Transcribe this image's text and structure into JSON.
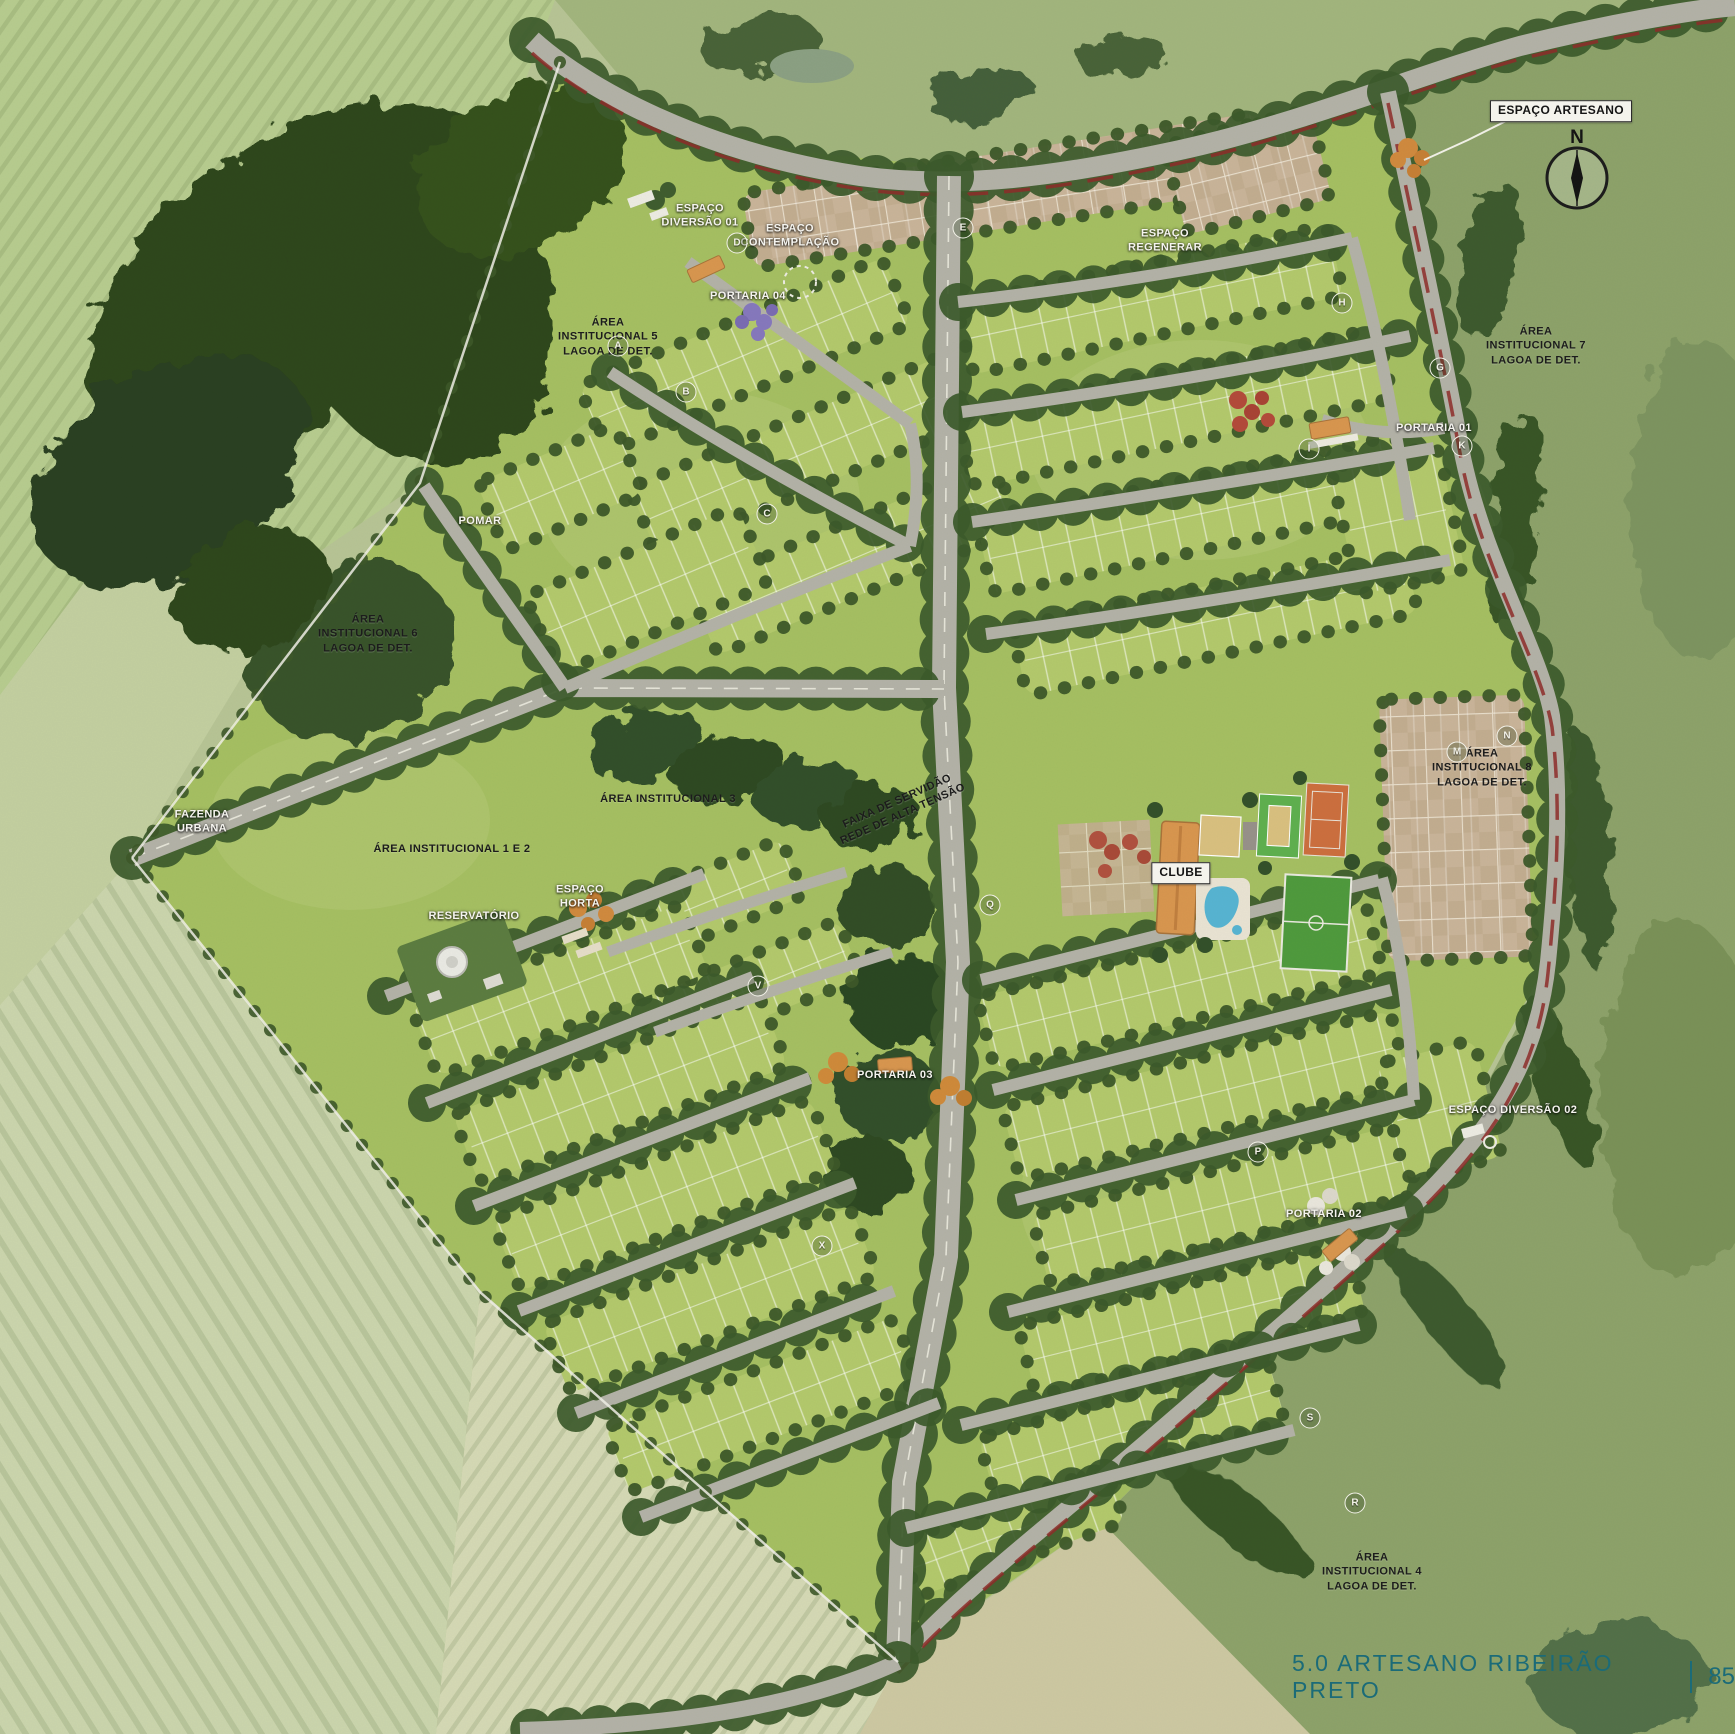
{
  "footer": {
    "caption": "5.0 ARTESANO RIBEIRÃO PRETO",
    "page": "85"
  },
  "compass": {
    "label": "N"
  },
  "colors": {
    "footer_teal": "#1b6b78",
    "label_light": "#f5f4ef",
    "label_dark": "#1c1c1c",
    "parcel_green": "#a5bf62",
    "block_green": "#b3c96c",
    "road_gray": "#b3b2a7",
    "tree_green": "#3c5a2b",
    "forest_green": "#2e461f",
    "paver_tan": "#c9b499",
    "accent_red": "#8e2b29",
    "pool_blue": "#57b4d2",
    "tennis_orange": "#cc6f3e",
    "soccer_green": "#4f9a3d",
    "clubhouse_orange": "#d8964f"
  },
  "labels": [
    {
      "text": "ESPAÇO ARTESANO",
      "x": 1561,
      "y": 111,
      "style": "boxed"
    },
    {
      "text": "ESPAÇO\nDIVERSÃO 01",
      "x": 700,
      "y": 216,
      "style": "light"
    },
    {
      "text": "ESPAÇO\nCONTEMPLAÇÃO",
      "x": 790,
      "y": 236,
      "style": "light"
    },
    {
      "text": "PORTARIA 04",
      "x": 748,
      "y": 296,
      "style": "light"
    },
    {
      "text": "ÁREA\nINSTITUCIONAL 5\nLAGOA DE DET.",
      "x": 608,
      "y": 337,
      "style": "dark"
    },
    {
      "text": "POMAR",
      "x": 480,
      "y": 521,
      "style": "light"
    },
    {
      "text": "ÁREA\nINSTITUCIONAL 6\nLAGOA DE DET.",
      "x": 368,
      "y": 634,
      "style": "dark"
    },
    {
      "text": "FAZENDA\nURBANA",
      "x": 202,
      "y": 822,
      "style": "light"
    },
    {
      "text": "ÁREA INSTITUCIONAL 1 E 2",
      "x": 452,
      "y": 849,
      "style": "dark"
    },
    {
      "text": "ÁREA INSTITUCIONAL 3",
      "x": 668,
      "y": 799,
      "style": "dark"
    },
    {
      "text": "FAIXA DE SERVIDÃO\nREDE DE ALTA TENSÃO",
      "x": 900,
      "y": 808,
      "style": "dark",
      "rotate": -24
    },
    {
      "text": "RESERVATÓRIO",
      "x": 474,
      "y": 916,
      "style": "light"
    },
    {
      "text": "ESPAÇO\nHORTA",
      "x": 580,
      "y": 897,
      "style": "light"
    },
    {
      "text": "ESPAÇO\nREGENERAR",
      "x": 1165,
      "y": 241,
      "style": "light"
    },
    {
      "text": "PORTARIA 01",
      "x": 1434,
      "y": 428,
      "style": "light"
    },
    {
      "text": "ÁREA\nINSTITUCIONAL 7\nLAGOA DE DET.",
      "x": 1536,
      "y": 346,
      "style": "dark"
    },
    {
      "text": "ÁREA\nINSTITUCIONAL 8\nLAGOA DE DET.",
      "x": 1482,
      "y": 768,
      "style": "dark"
    },
    {
      "text": "PORTARIA 03",
      "x": 895,
      "y": 1075,
      "style": "light"
    },
    {
      "text": "ESPAÇO DIVERSÃO 02",
      "x": 1513,
      "y": 1110,
      "style": "light"
    },
    {
      "text": "PORTARIA 02",
      "x": 1324,
      "y": 1214,
      "style": "light"
    },
    {
      "text": "ÁREA\nINSTITUCIONAL 4\nLAGOA DE DET.",
      "x": 1372,
      "y": 1572,
      "style": "dark"
    },
    {
      "text": "CLUBE",
      "x": 1181,
      "y": 873,
      "style": "boxed"
    }
  ],
  "block_markers": [
    {
      "letter": "A",
      "x": 618,
      "y": 346
    },
    {
      "letter": "B",
      "x": 686,
      "y": 392
    },
    {
      "letter": "C",
      "x": 767,
      "y": 514
    },
    {
      "letter": "D",
      "x": 737,
      "y": 243
    },
    {
      "letter": "E",
      "x": 963,
      "y": 228
    },
    {
      "letter": "G",
      "x": 1440,
      "y": 368
    },
    {
      "letter": "H",
      "x": 1342,
      "y": 303
    },
    {
      "letter": "I",
      "x": 1309,
      "y": 449
    },
    {
      "letter": "K",
      "x": 1462,
      "y": 446
    },
    {
      "letter": "M",
      "x": 1457,
      "y": 752
    },
    {
      "letter": "N",
      "x": 1507,
      "y": 736
    },
    {
      "letter": "Q",
      "x": 990,
      "y": 905
    },
    {
      "letter": "V",
      "x": 758,
      "y": 986
    },
    {
      "letter": "P",
      "x": 1258,
      "y": 1152
    },
    {
      "letter": "X",
      "x": 822,
      "y": 1246
    },
    {
      "letter": "S",
      "x": 1310,
      "y": 1418
    },
    {
      "letter": "R",
      "x": 1355,
      "y": 1503
    }
  ],
  "map": {
    "parcel": {
      "pts": "560,62 640,100 800,152 1005,172 1390,92 1458,430 1560,700 1548,960 1420,1198 1100,1520 897,1660 480,1290 130,857 420,483",
      "fill": "#a5bf62"
    },
    "fields": [
      {
        "pts": "0,0 555,0 520,95 420,483 300,565 90,575 0,695",
        "fill": "#b7cc8f",
        "stripes": "rows35"
      },
      {
        "pts": "0,695 90,575 300,565 255,655 132,858 0,1005",
        "fill": "#c3cfa0"
      },
      {
        "pts": "0,1005 132,858 480,1292 436,1734 0,1734",
        "fill": "#cbd5ad",
        "stripes": "rowsM30"
      },
      {
        "pts": "436,1734 480,1292 700,1480 898,1662 860,1734",
        "fill": "#d5d9b5",
        "stripes": "rows35"
      },
      {
        "pts": "860,1734 898,1662 1100,1520 1310,1734",
        "fill": "#cdc8a2"
      },
      {
        "pts": "1310,1734 1100,1520 1430,1190 1552,962 1560,700 1460,430 1388,92 1520,48 1735,0 1735,1734",
        "fill": "#8da26a"
      },
      {
        "pts": "520,0 1735,0 1520,48 1180,150 1005,170 860,175 640,100 555,0",
        "fill": "#a2b57d"
      }
    ],
    "mottle": [
      {
        "cx": 700,
        "cy": 500,
        "rx": 160,
        "ry": 110
      },
      {
        "cx": 1200,
        "cy": 450,
        "rx": 170,
        "ry": 110
      },
      {
        "cx": 660,
        "cy": 1180,
        "rx": 150,
        "ry": 110
      },
      {
        "cx": 1180,
        "cy": 1200,
        "rx": 160,
        "ry": 120
      },
      {
        "cx": 350,
        "cy": 820,
        "rx": 140,
        "ry": 90
      }
    ],
    "forest": [
      {
        "cx": 300,
        "cy": 280,
        "rx": 240,
        "ry": 140,
        "rot": -35,
        "fill": "#2e461f"
      },
      {
        "cx": 170,
        "cy": 470,
        "rx": 150,
        "ry": 100,
        "rot": -35,
        "fill": "#2a4120"
      },
      {
        "cx": 420,
        "cy": 300,
        "rx": 130,
        "ry": 170,
        "rot": -20,
        "fill": "#2e461f"
      },
      {
        "cx": 520,
        "cy": 170,
        "rx": 110,
        "ry": 80,
        "rot": -30,
        "fill": "#35511f"
      },
      {
        "cx": 350,
        "cy": 650,
        "rx": 105,
        "ry": 85,
        "rot": -25,
        "fill": "#39522a"
      },
      {
        "cx": 250,
        "cy": 590,
        "rx": 80,
        "ry": 60,
        "rot": -25,
        "fill": "#2e461f"
      },
      {
        "cx": 645,
        "cy": 745,
        "rx": 60,
        "ry": 34,
        "rot": -15,
        "fill": "#33502a"
      },
      {
        "cx": 730,
        "cy": 770,
        "rx": 58,
        "ry": 32,
        "rot": -12,
        "fill": "#2f4a24"
      },
      {
        "cx": 810,
        "cy": 795,
        "rx": 55,
        "ry": 32,
        "rot": -10,
        "fill": "#33502a"
      },
      {
        "cx": 872,
        "cy": 818,
        "rx": 48,
        "ry": 30,
        "rot": -10,
        "fill": "#2f4a24"
      },
      {
        "cx": 885,
        "cy": 905,
        "rx": 50,
        "ry": 40,
        "rot": 0,
        "fill": "#314d26"
      },
      {
        "cx": 900,
        "cy": 1000,
        "rx": 55,
        "ry": 48,
        "rot": 0,
        "fill": "#2c4621"
      },
      {
        "cx": 888,
        "cy": 1095,
        "rx": 52,
        "ry": 46,
        "rot": 0,
        "fill": "#33502a"
      },
      {
        "cx": 868,
        "cy": 1175,
        "rx": 45,
        "ry": 38,
        "rot": 0,
        "fill": "#2f4a24"
      },
      {
        "cx": 760,
        "cy": 45,
        "rx": 60,
        "ry": 28,
        "rot": -8,
        "fill": "#4a6337"
      },
      {
        "cx": 980,
        "cy": 95,
        "rx": 55,
        "ry": 25,
        "rot": -8,
        "fill": "#44603a"
      },
      {
        "cx": 1120,
        "cy": 55,
        "rx": 45,
        "ry": 20,
        "rot": -8,
        "fill": "#4a6337"
      },
      {
        "cx": 1490,
        "cy": 260,
        "rx": 26,
        "ry": 80,
        "rot": 12,
        "fill": "#3c5a2e"
      },
      {
        "cx": 1515,
        "cy": 520,
        "rx": 24,
        "ry": 110,
        "rot": 6,
        "fill": "#375428"
      },
      {
        "cx": 1588,
        "cy": 850,
        "rx": 22,
        "ry": 120,
        "rot": -4,
        "fill": "#3c5a2e"
      },
      {
        "cx": 1560,
        "cy": 1080,
        "rx": 24,
        "ry": 90,
        "rot": -18,
        "fill": "#375428"
      },
      {
        "cx": 1450,
        "cy": 1320,
        "rx": 24,
        "ry": 90,
        "rot": -38,
        "fill": "#3c5a2e"
      },
      {
        "cx": 1240,
        "cy": 1520,
        "rx": 26,
        "ry": 90,
        "rot": -52,
        "fill": "#375428"
      },
      {
        "cx": 1620,
        "cy": 1680,
        "rx": 90,
        "ry": 60,
        "rot": 0,
        "fill": "#52704a"
      },
      {
        "cx": 1700,
        "cy": 500,
        "rx": 70,
        "ry": 160,
        "rot": 0,
        "fill": "#7d9460"
      },
      {
        "cx": 1680,
        "cy": 1100,
        "rx": 80,
        "ry": 180,
        "rot": 0,
        "fill": "#7a9158"
      }
    ],
    "blocks": [
      {
        "cx": 745,
        "cy": 355,
        "w": 330,
        "h": 72,
        "r": -23
      },
      {
        "cx": 800,
        "cy": 455,
        "w": 340,
        "h": 72,
        "r": -23
      },
      {
        "cx": 855,
        "cy": 558,
        "w": 330,
        "h": 72,
        "r": -23
      },
      {
        "cx": 648,
        "cy": 590,
        "w": 230,
        "h": 84,
        "r": -23
      },
      {
        "cx": 560,
        "cy": 488,
        "w": 150,
        "h": 74,
        "r": -23
      },
      {
        "cx": 1150,
        "cy": 300,
        "w": 380,
        "h": 72,
        "r": -12
      },
      {
        "cx": 1175,
        "cy": 408,
        "w": 430,
        "h": 72,
        "r": -12
      },
      {
        "cx": 1195,
        "cy": 515,
        "w": 430,
        "h": 72,
        "r": -12
      },
      {
        "cx": 1215,
        "cy": 620,
        "w": 400,
        "h": 70,
        "r": -12
      },
      {
        "cx": 1398,
        "cy": 520,
        "w": 110,
        "h": 130,
        "r": -12
      },
      {
        "cx": 700,
        "cy": 905,
        "w": 200,
        "h": 62,
        "r": -22
      },
      {
        "cx": 748,
        "cy": 990,
        "w": 220,
        "h": 62,
        "r": -22
      },
      {
        "cx": 560,
        "cy": 990,
        "w": 290,
        "h": 74,
        "r": -21
      },
      {
        "cx": 620,
        "cy": 1090,
        "w": 330,
        "h": 76,
        "r": -21
      },
      {
        "cx": 665,
        "cy": 1195,
        "w": 340,
        "h": 76,
        "r": -21
      },
      {
        "cx": 710,
        "cy": 1300,
        "w": 330,
        "h": 74,
        "r": -21
      },
      {
        "cx": 762,
        "cy": 1405,
        "w": 310,
        "h": 70,
        "r": -21
      },
      {
        "cx": 1180,
        "cy": 985,
        "w": 400,
        "h": 74,
        "r": -14
      },
      {
        "cx": 1205,
        "cy": 1095,
        "w": 400,
        "h": 74,
        "r": -14
      },
      {
        "cx": 1225,
        "cy": 1205,
        "w": 380,
        "h": 72,
        "r": -14
      },
      {
        "cx": 1192,
        "cy": 1320,
        "w": 340,
        "h": 72,
        "r": -14
      },
      {
        "cx": 1132,
        "cy": 1430,
        "w": 300,
        "h": 68,
        "r": -16
      },
      {
        "cx": 1012,
        "cy": 1532,
        "w": 220,
        "h": 58,
        "r": -20
      },
      {
        "cx": 1440,
        "cy": 1110,
        "w": 100,
        "h": 120,
        "r": -14
      },
      {
        "cx": 1005,
        "cy": 190,
        "w": 520,
        "h": 75,
        "r": -9,
        "t": "paver"
      },
      {
        "cx": 1248,
        "cy": 172,
        "w": 150,
        "h": 92,
        "r": -14,
        "t": "paver"
      },
      {
        "cx": 1456,
        "cy": 828,
        "w": 145,
        "h": 262,
        "r": -2,
        "t": "paver"
      }
    ],
    "roads": [
      {
        "d": "M532,40 C585,88 700,152 860,176 C960,190 1060,176 1180,150 C1300,124 1420,74 1520,46 C1610,24 1690,10 1735,6",
        "w": 20,
        "trees": 1,
        "red": 1
      },
      {
        "d": "M1388,92 C1412,205 1438,325 1460,442 C1480,556 1540,648 1552,716 C1562,800 1556,882 1548,962 C1538,1058 1496,1122 1430,1190 C1356,1262 1238,1362 1146,1442 C1040,1533 958,1594 898,1662",
        "w": 16,
        "trees": 1,
        "red": 1
      },
      {
        "d": "M949,176 L944,688 L958,962 L946,1256 L904,1482 L898,1662",
        "w": 24,
        "trees": 1,
        "dash": 1
      },
      {
        "d": "M132,858 L565,688 L944,689",
        "w": 18,
        "trees": 1,
        "dash": 1
      },
      {
        "d": "M424,486 C468,552 520,622 565,688",
        "w": 13,
        "trees": 1
      },
      {
        "d": "M688,262 C768,320 840,372 910,424",
        "w": 12
      },
      {
        "d": "M610,372 C700,432 806,492 910,546",
        "w": 12,
        "trees": 1
      },
      {
        "d": "M565,688 C680,638 795,590 910,546",
        "w": 12
      },
      {
        "d": "M910,424 C920,465 918,506 910,546",
        "w": 12
      },
      {
        "d": "M958,302 C1100,286 1240,262 1352,238",
        "w": 12,
        "trees": 1
      },
      {
        "d": "M962,412 C1110,392 1268,366 1410,336",
        "w": 12,
        "trees": 1
      },
      {
        "d": "M972,522 C1122,500 1282,474 1434,448",
        "w": 12,
        "trees": 1
      },
      {
        "d": "M986,634 C1132,614 1292,588 1450,560",
        "w": 12,
        "trees": 1
      },
      {
        "d": "M1352,238 C1378,332 1396,428 1410,520",
        "w": 12
      },
      {
        "d": "M1322,420 C1360,432 1402,436 1444,428",
        "w": 12
      },
      {
        "d": "M981,980 L1379,880",
        "w": 12,
        "trees": 1
      },
      {
        "d": "M993,1090 L1391,990",
        "w": 12,
        "trees": 1
      },
      {
        "d": "M1016,1200 L1414,1100",
        "w": 12,
        "trees": 1
      },
      {
        "d": "M1008,1312 L1406,1212",
        "w": 12,
        "trees": 1
      },
      {
        "d": "M961,1425 L1359,1325",
        "w": 12,
        "trees": 1
      },
      {
        "d": "M906,1528 L1294,1430",
        "w": 12,
        "trees": 1
      },
      {
        "d": "M1382,878 C1402,952 1410,1028 1414,1100",
        "w": 12
      },
      {
        "d": "M386,996 L704,874",
        "w": 12,
        "trees": 1
      },
      {
        "d": "M427,1103 L753,977",
        "w": 12,
        "trees": 1
      },
      {
        "d": "M474,1206 L810,1078",
        "w": 12,
        "trees": 1
      },
      {
        "d": "M519,1311 L855,1183",
        "w": 12,
        "trees": 1
      },
      {
        "d": "M576,1413 L894,1291",
        "w": 12,
        "trees": 1
      },
      {
        "d": "M641,1517 L939,1403",
        "w": 12,
        "trees": 1
      },
      {
        "d": "M608,952 C690,922 770,895 846,872",
        "w": 11
      },
      {
        "d": "M655,1032 C735,1003 815,976 892,952",
        "w": 11
      },
      {
        "d": "M898,1662 C790,1712 650,1726 520,1730",
        "w": 16,
        "trees": 1
      }
    ],
    "flora": [
      {
        "cx": 752,
        "cy": 312,
        "r": 9,
        "fill": "#8678bd"
      },
      {
        "cx": 764,
        "cy": 322,
        "r": 8,
        "fill": "#8678bd"
      },
      {
        "cx": 742,
        "cy": 322,
        "r": 7,
        "fill": "#7a6cb2"
      },
      {
        "cx": 758,
        "cy": 334,
        "r": 7,
        "fill": "#8678bd"
      },
      {
        "cx": 772,
        "cy": 310,
        "r": 6,
        "fill": "#7a6cb2"
      },
      {
        "cx": 1238,
        "cy": 400,
        "r": 9,
        "fill": "#b34a3a"
      },
      {
        "cx": 1252,
        "cy": 412,
        "r": 8,
        "fill": "#a84335"
      },
      {
        "cx": 1240,
        "cy": 424,
        "r": 8,
        "fill": "#b34a3a"
      },
      {
        "cx": 1262,
        "cy": 398,
        "r": 7,
        "fill": "#a84335"
      },
      {
        "cx": 1268,
        "cy": 420,
        "r": 7,
        "fill": "#b34a3a"
      },
      {
        "cx": 1408,
        "cy": 148,
        "r": 10,
        "fill": "#d08a3e"
      },
      {
        "cx": 1422,
        "cy": 158,
        "r": 8,
        "fill": "#c67f35"
      },
      {
        "cx": 1398,
        "cy": 160,
        "r": 8,
        "fill": "#d08a3e"
      },
      {
        "cx": 1414,
        "cy": 171,
        "r": 7,
        "fill": "#c67f35"
      },
      {
        "cx": 578,
        "cy": 908,
        "r": 9,
        "fill": "#d08a3e"
      },
      {
        "cx": 594,
        "cy": 900,
        "r": 8,
        "fill": "#c67f35"
      },
      {
        "cx": 606,
        "cy": 914,
        "r": 8,
        "fill": "#d08a3e"
      },
      {
        "cx": 588,
        "cy": 924,
        "r": 7,
        "fill": "#c67f35"
      },
      {
        "cx": 838,
        "cy": 1062,
        "r": 10,
        "fill": "#cf8a3a"
      },
      {
        "cx": 852,
        "cy": 1074,
        "r": 8,
        "fill": "#c07e31"
      },
      {
        "cx": 826,
        "cy": 1076,
        "r": 8,
        "fill": "#cf8a3a"
      },
      {
        "cx": 950,
        "cy": 1086,
        "r": 10,
        "fill": "#cf8a3a"
      },
      {
        "cx": 964,
        "cy": 1098,
        "r": 8,
        "fill": "#c07e31"
      },
      {
        "cx": 938,
        "cy": 1097,
        "r": 8,
        "fill": "#cf8a3a"
      },
      {
        "cx": 1316,
        "cy": 1206,
        "r": 9,
        "fill": "#e9e6dc"
      },
      {
        "cx": 1330,
        "cy": 1196,
        "r": 8,
        "fill": "#dcd8cb"
      },
      {
        "cx": 1342,
        "cy": 1252,
        "r": 9,
        "fill": "#e9e6dc"
      },
      {
        "cx": 1352,
        "cy": 1262,
        "r": 8,
        "fill": "#dcd8cb"
      },
      {
        "cx": 1326,
        "cy": 1268,
        "r": 7,
        "fill": "#e9e6dc"
      },
      {
        "cx": 655,
        "cy": 200,
        "r": 10,
        "fill": "#3f5d2f"
      },
      {
        "cx": 668,
        "cy": 190,
        "r": 8,
        "fill": "#3f5d2f"
      }
    ]
  }
}
